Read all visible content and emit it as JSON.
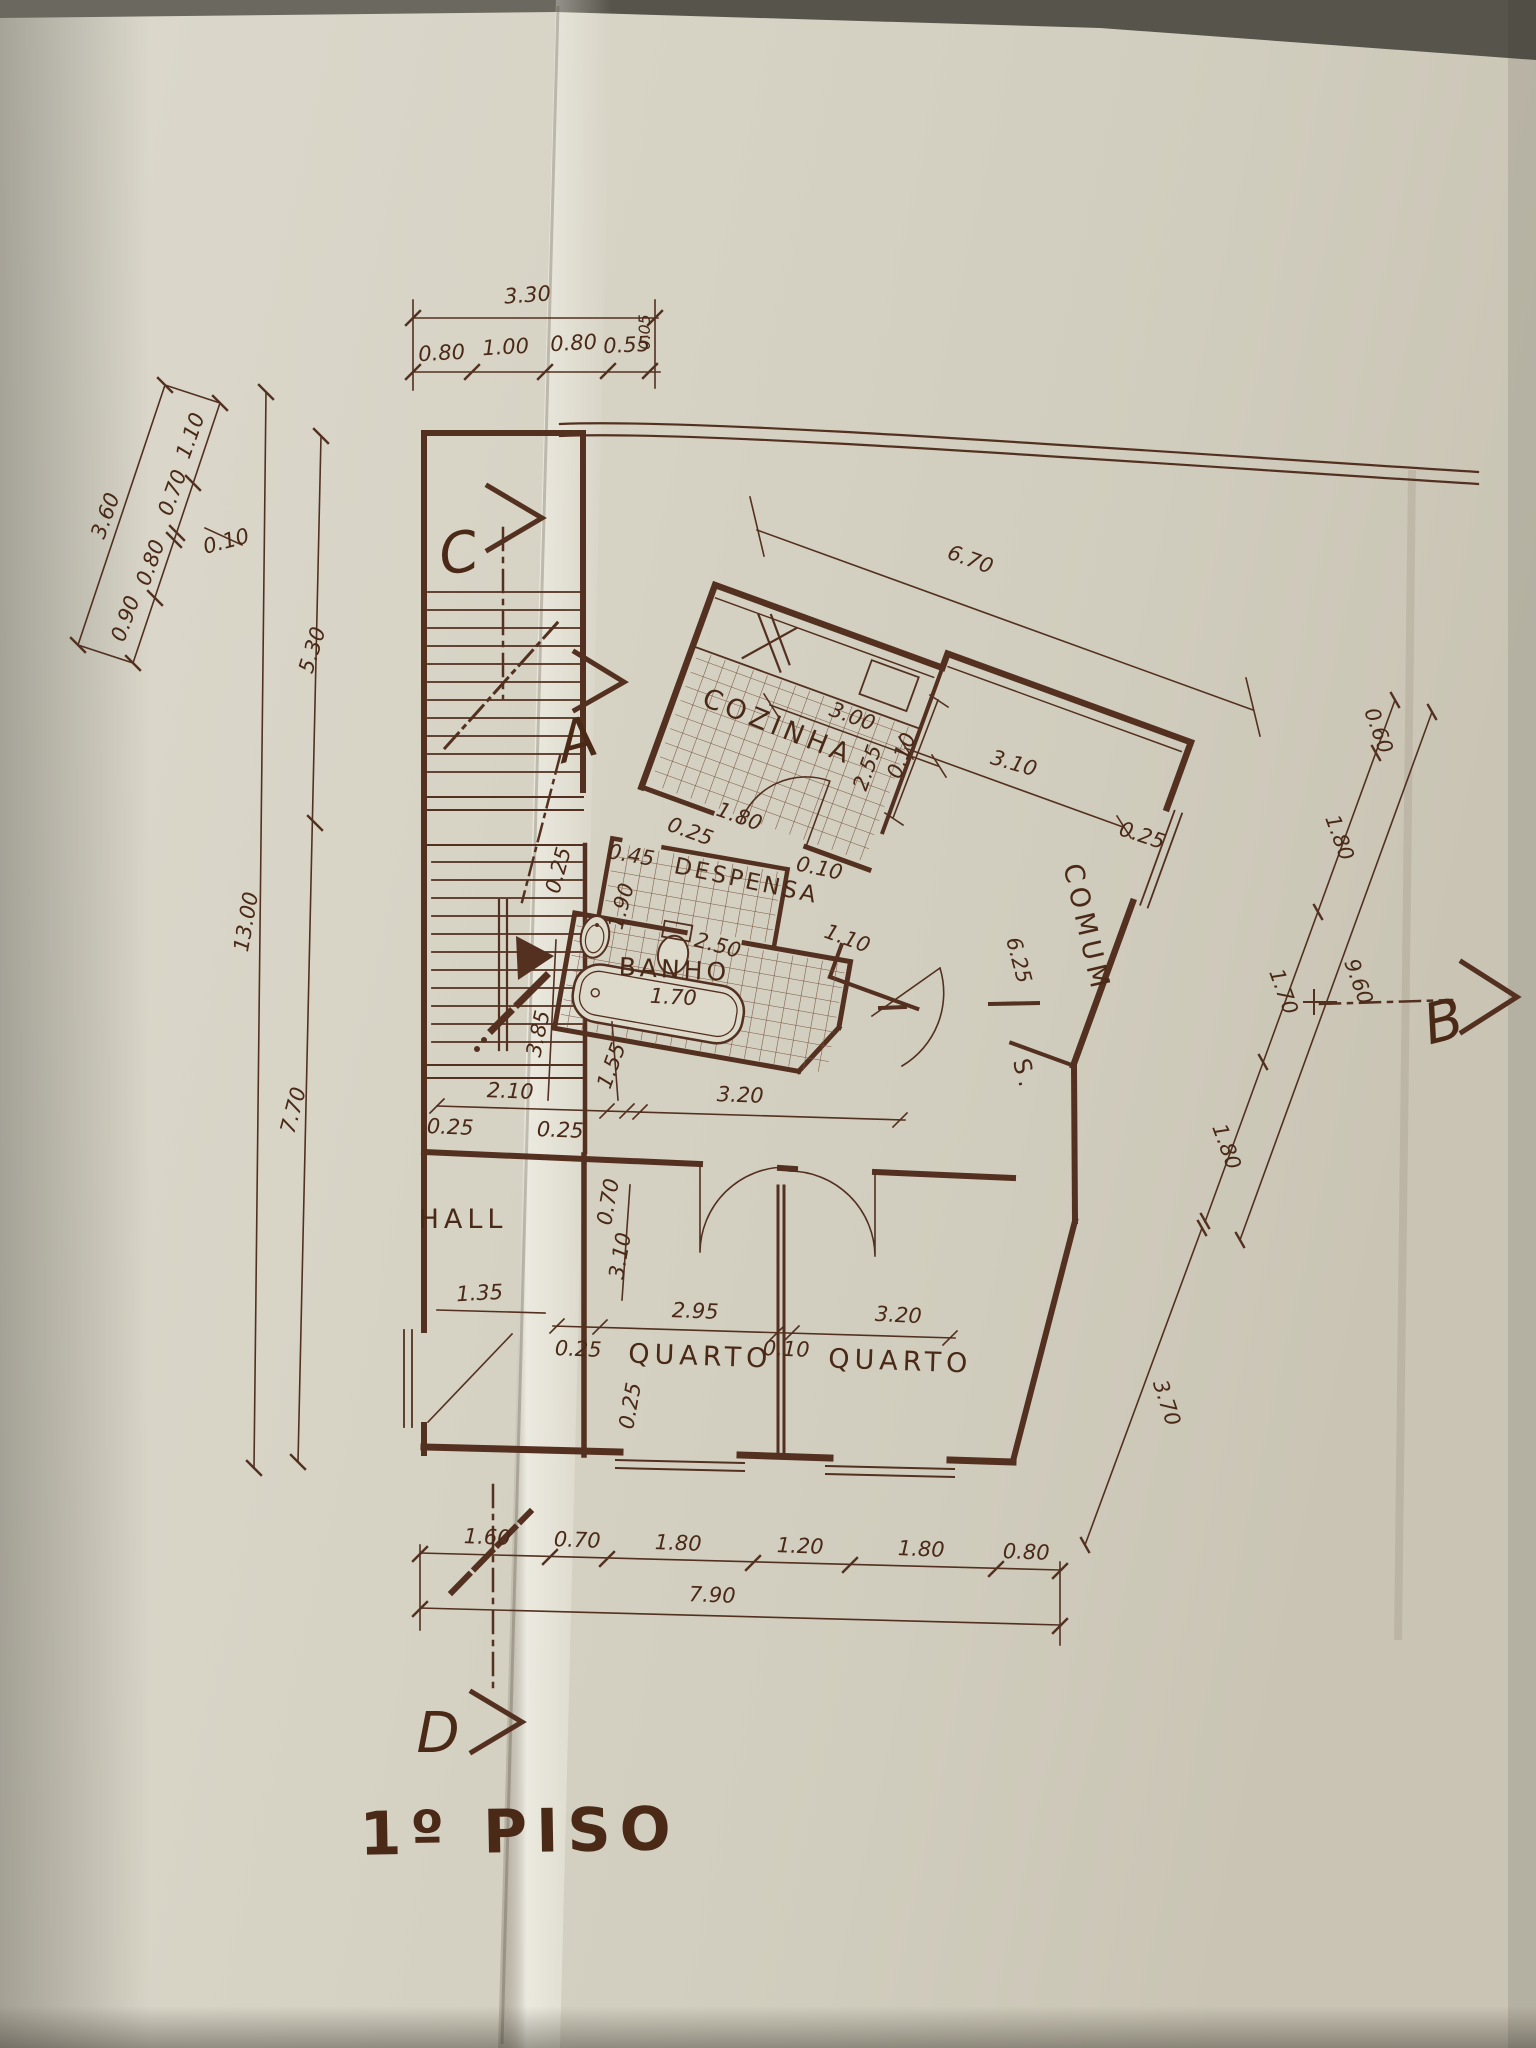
{
  "title": "1º PISO",
  "markers": {
    "a": "A",
    "b": "B",
    "c": "C",
    "d": "D"
  },
  "rooms": {
    "cozinha": "COZINHA",
    "despensa": "DESPENSA",
    "banho": "BANHO",
    "sala_prefix": "S.",
    "sala": "COMUM",
    "quarto1": "QUARTO",
    "quarto2": "QUARTO",
    "hall": "HALL"
  },
  "dims": {
    "top": {
      "total": "3.30",
      "s1": "0.80",
      "s2": "1.00",
      "s3": "0.80",
      "s4": "0.55",
      "s5": "0.05"
    },
    "left_diag": {
      "total": "3.60",
      "s1": "1.10",
      "s2": "0.70",
      "s3": "0.10",
      "s4": "0.80",
      "s5": "0.90"
    },
    "left": {
      "total": "13.00",
      "upper": "5.30",
      "lower": "7.70"
    },
    "kitchen": {
      "overall": "6.70",
      "width": "3.00",
      "depth": "2.55",
      "wall": "0.10",
      "door": "1.80",
      "jamb": "0.25"
    },
    "sala": {
      "window": "3.10",
      "wall": "0.25",
      "length": "6.25",
      "entry": "1.10"
    },
    "despensa": {
      "jamb": "0.25",
      "door": "0.45",
      "depth": "1.90",
      "wall": "0.10"
    },
    "banho": {
      "width": "2.50",
      "tub": "1.70"
    },
    "middle": {
      "stair": "3.85",
      "landing": "1.55",
      "corridor": "2.10",
      "jamb_left": "0.25",
      "jamb_right": "0.25",
      "span": "3.20"
    },
    "quartos": {
      "depth": "3.10",
      "door": "0.70",
      "q1_width": "2.95",
      "wall": "0.10",
      "jamb": "0.25",
      "q2_width": "3.20",
      "wall_q": "0.25",
      "hall_width": "1.35"
    },
    "right": {
      "s1": "0.60",
      "s2": "1.80",
      "s3": "1.70",
      "s4": "1.80",
      "total": "9.60",
      "lower": "3.70"
    },
    "bottom": {
      "s1": "1.60",
      "s2": "0.70",
      "s3": "1.80",
      "s4": "1.20",
      "s5": "1.80",
      "s6": "0.80",
      "total": "7.90"
    }
  }
}
